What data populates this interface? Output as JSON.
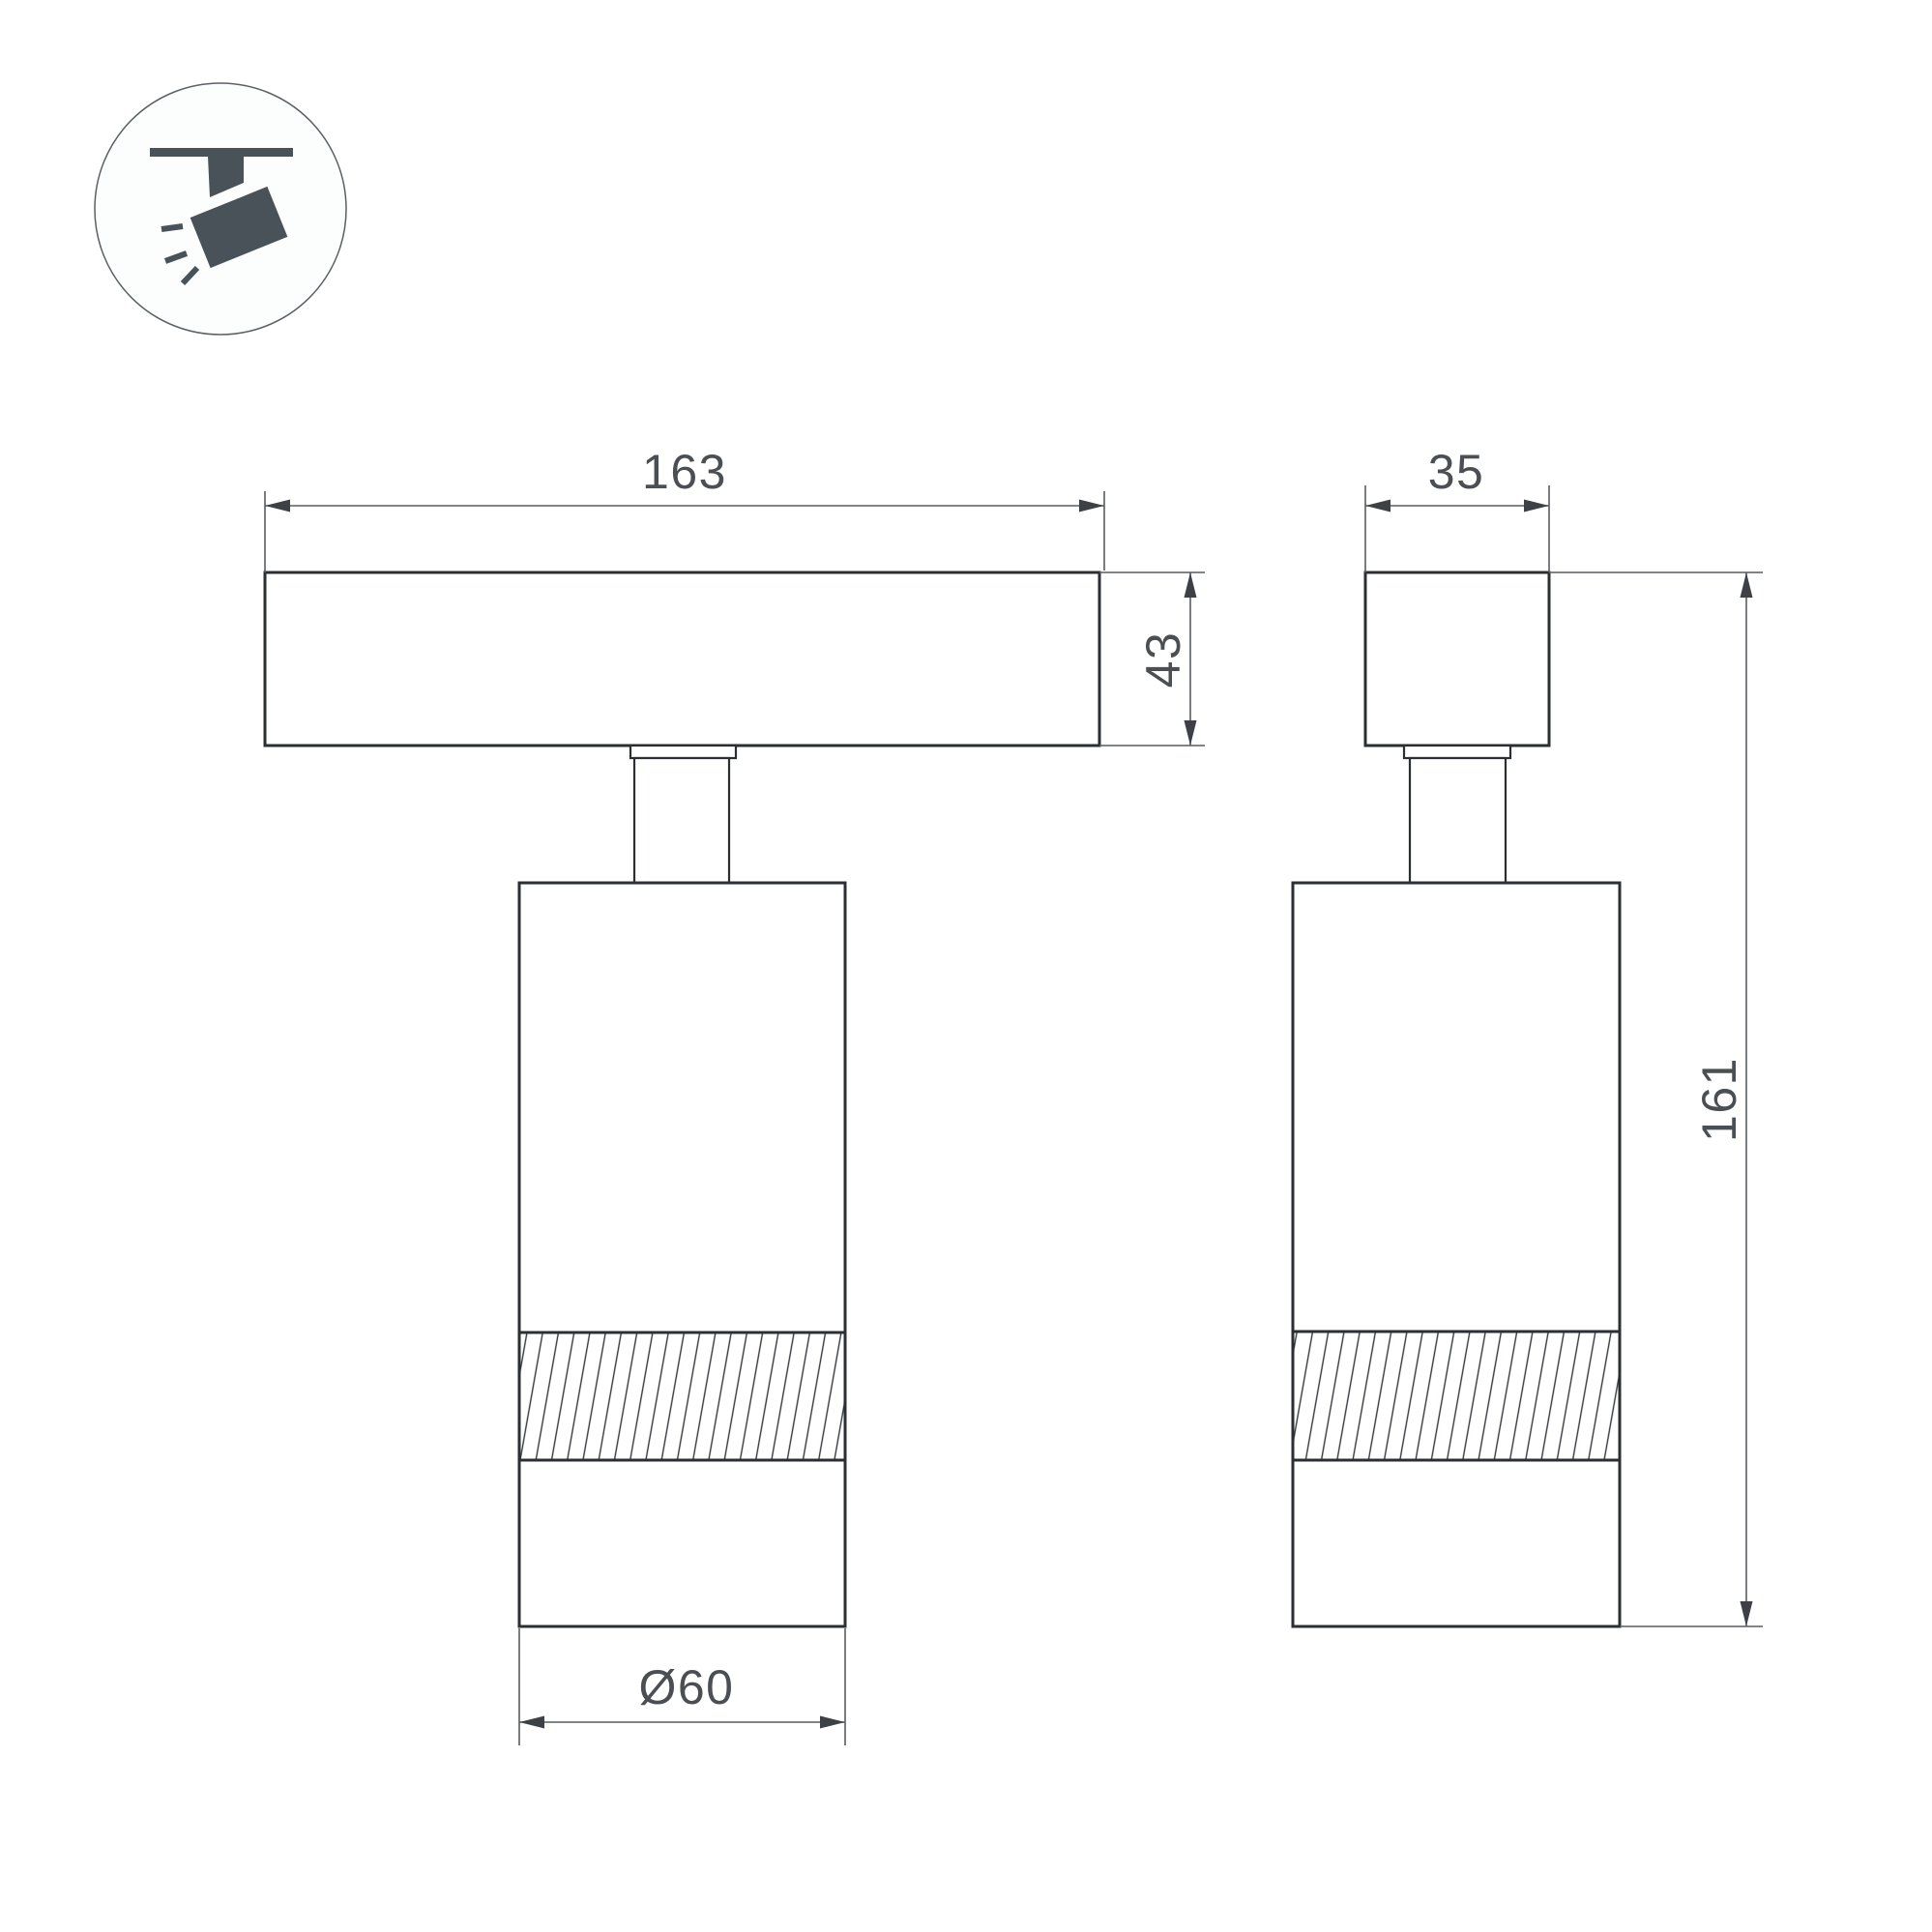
{
  "drawing": {
    "icon": {
      "name": "ceiling-track-spotlight"
    },
    "front_view": {
      "rail_width_label": "163",
      "rail_height_label": "43",
      "body_diameter_label": "Ø60"
    },
    "side_view": {
      "rail_depth_label": "35",
      "total_height_label": "161"
    },
    "colors": {
      "outline": "#2b2f33",
      "dimension_line": "#595d61",
      "arrow": "#3d4145",
      "text": "#4b4f53",
      "icon": "#4a5259",
      "background": "#ffffff"
    }
  }
}
